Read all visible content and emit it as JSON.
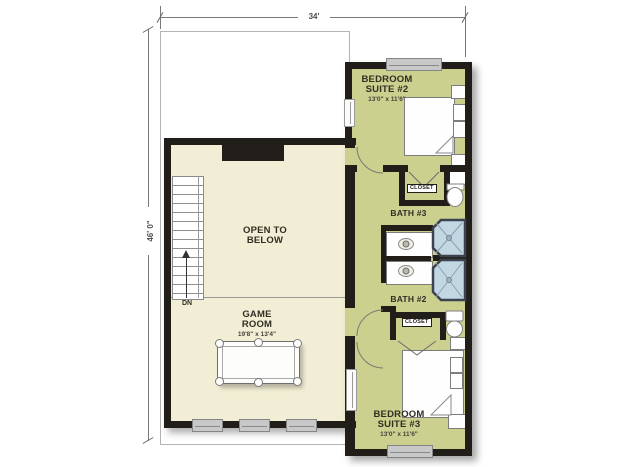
{
  "plan_title": "Second floor plan",
  "dimensions": {
    "top_width": "34'",
    "left_height": "46' 0\""
  },
  "rooms": {
    "bedroom_suite_2": {
      "name_line1": "BEDROOM",
      "name_line2": "SUITE #2",
      "size": "13'0\" x 11'6\""
    },
    "bedroom_suite_3": {
      "name_line1": "BEDROOM",
      "name_line2": "SUITE #3",
      "size": "13'0\" x 11'6\""
    },
    "game_room": {
      "name_line1": "GAME",
      "name_line2": "ROOM",
      "size": "19'8\" x 13'4\""
    },
    "open_to_below": {
      "name_line1": "OPEN TO",
      "name_line2": "BELOW"
    },
    "bath_3": {
      "name": "BATH #3"
    },
    "bath_2": {
      "name": "BATH #2"
    },
    "closet_bath3": {
      "name": "CLOSET"
    },
    "closet_bath2": {
      "name": "CLOSET"
    },
    "stairs": {
      "direction": "DN"
    }
  },
  "colors": {
    "room_cream": "#f2eed5",
    "room_olive": "#cbd08f",
    "wall": "#211e19",
    "shower_blue": "#c3d7e3",
    "window_gray": "#c8c8c8"
  }
}
